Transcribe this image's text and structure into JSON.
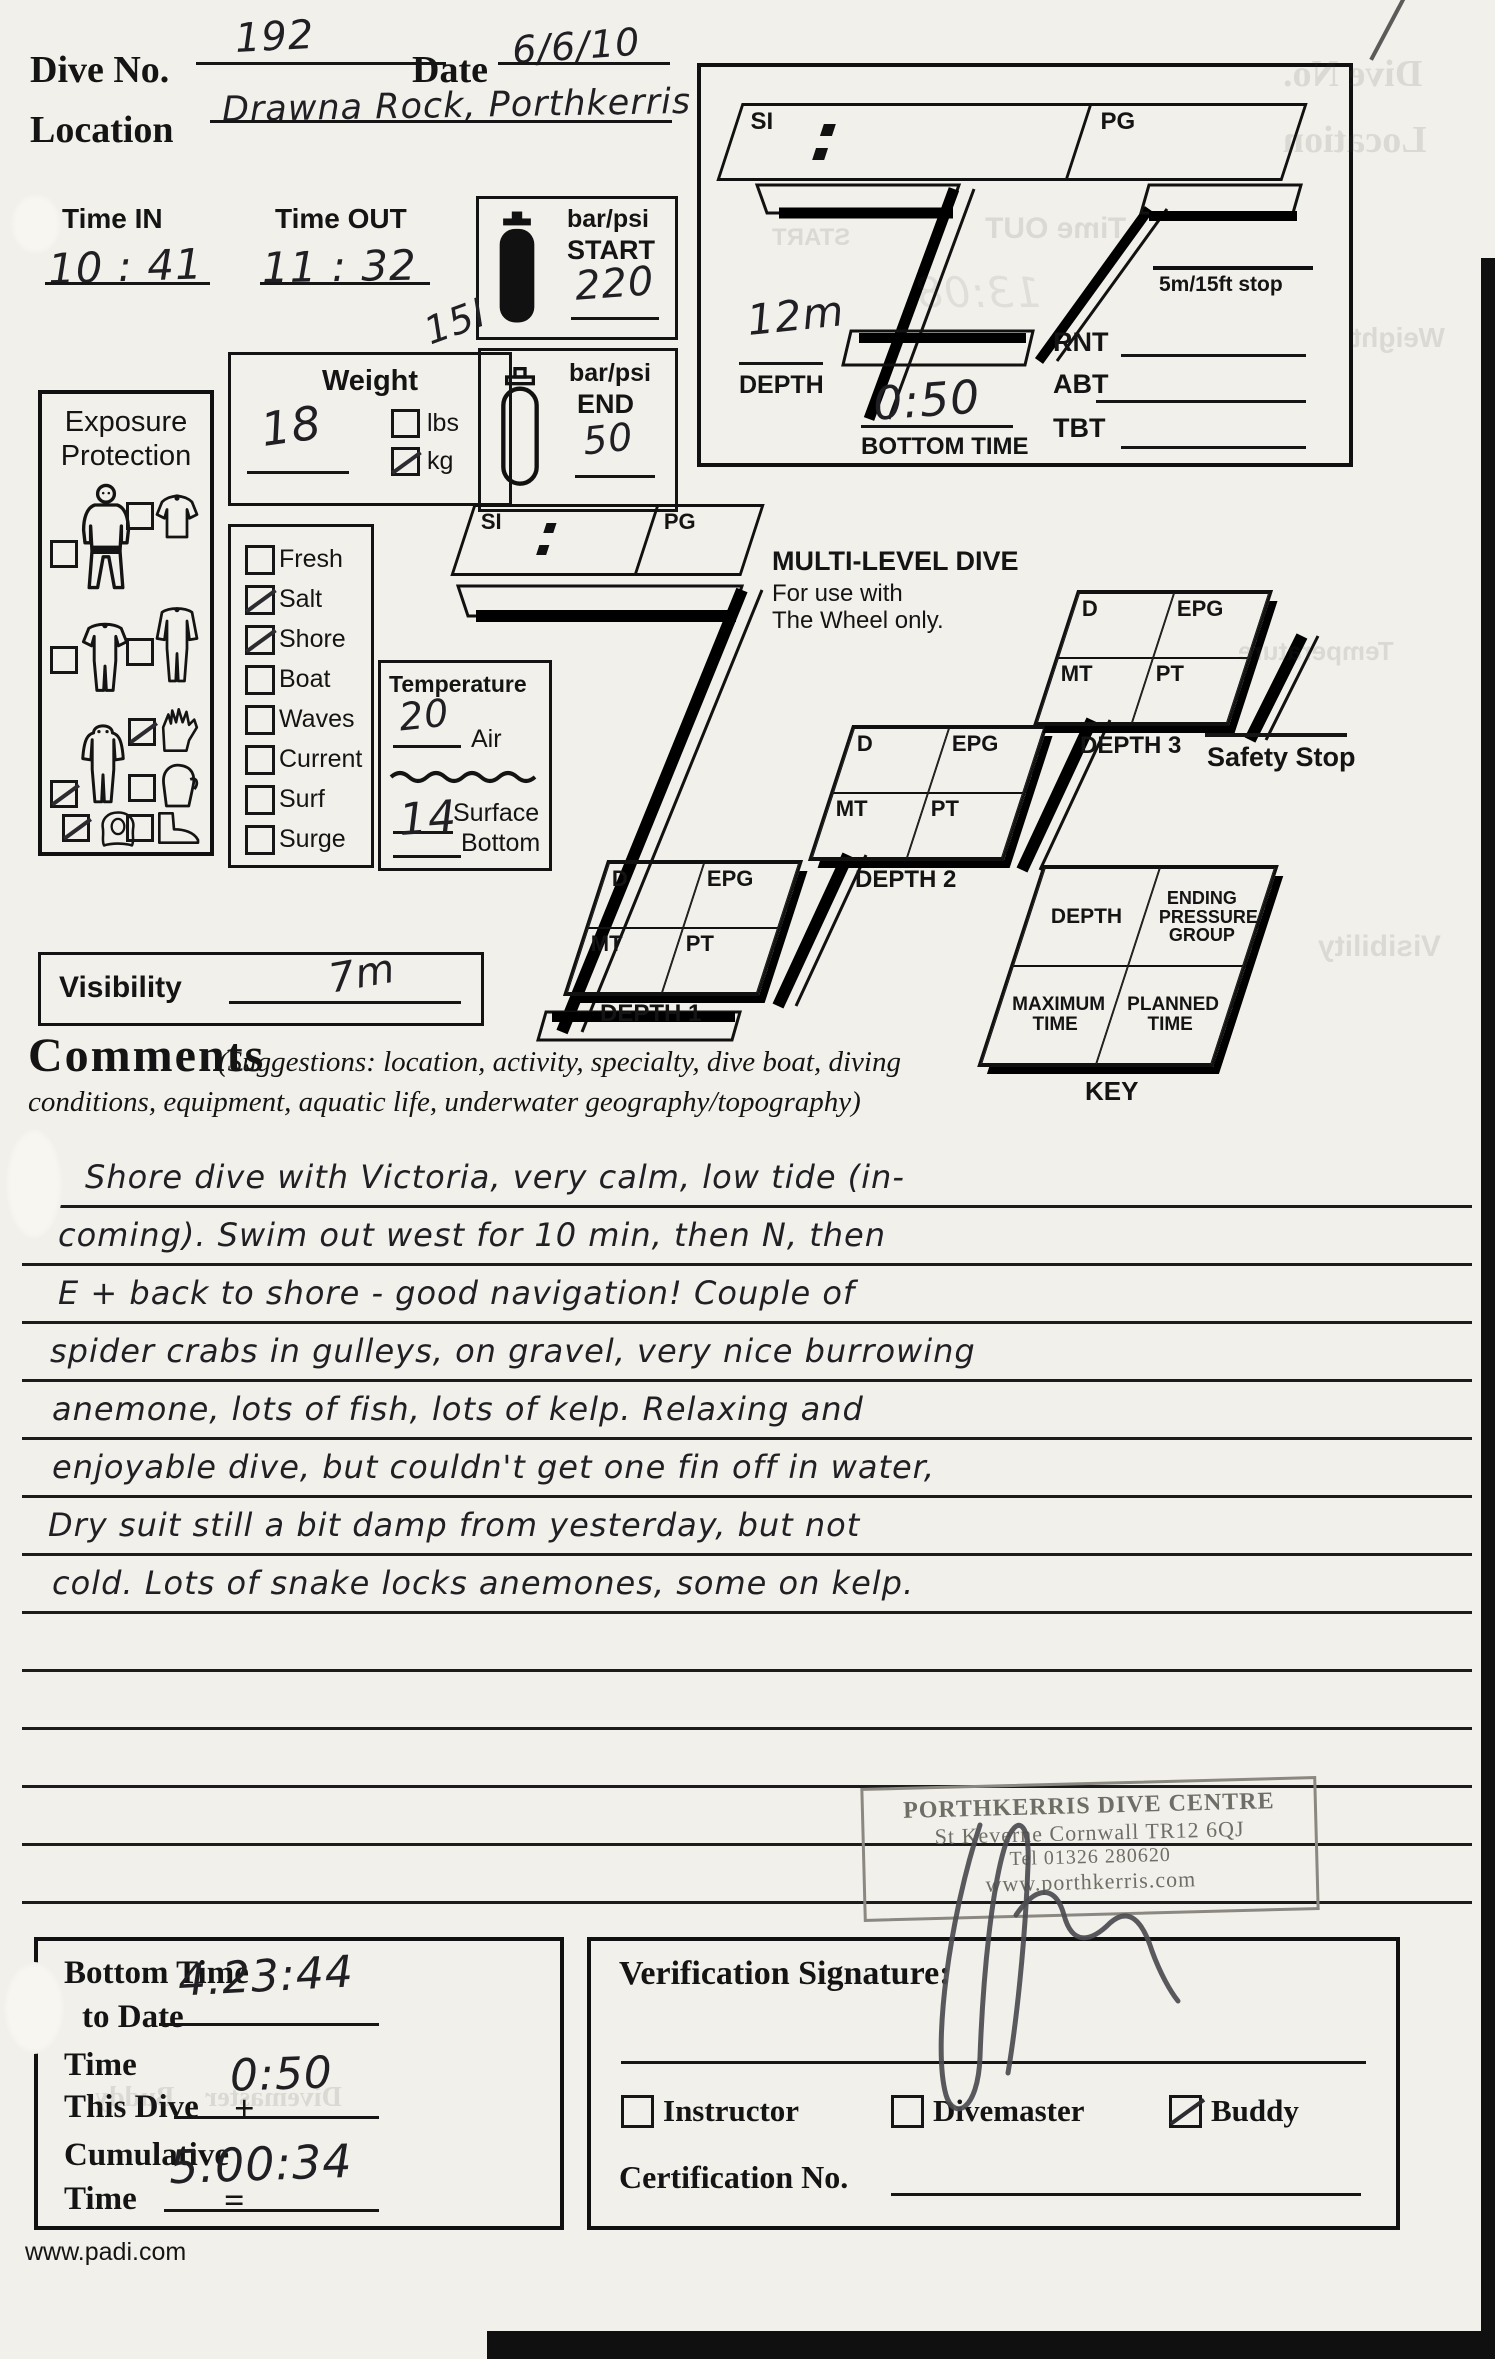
{
  "header": {
    "dive_no_label": "Dive No.",
    "dive_no_value": "192",
    "date_label": "Date",
    "date_value": "6/6/10",
    "location_label": "Location",
    "location_value": "Drawna Rock, Porthkerris",
    "time_in_label": "Time IN",
    "time_in_value": "10 : 41",
    "time_out_label": "Time OUT",
    "time_out_value": "11 : 32"
  },
  "tank": {
    "units_label": "bar/psi",
    "start_label": "START",
    "start_value": "220",
    "end_label": "END",
    "end_value": "50",
    "size_note": "15l"
  },
  "profile_top": {
    "si_label": "SI",
    "pg_label": "PG",
    "stop_label": "5m/15ft stop",
    "rnt_label": "RNT",
    "abt_label": "ABT",
    "tbt_label": "TBT",
    "depth_label": "DEPTH",
    "depth_value": "12m",
    "bottom_time_label": "BOTTOM TIME",
    "bottom_time_value": "0:50"
  },
  "weight": {
    "title": "Weight",
    "value": "18",
    "lbs_label": "lbs",
    "lbs_checked": false,
    "kg_label": "kg",
    "kg_checked": true
  },
  "exposure": {
    "title_line1": "Exposure",
    "title_line2": "Protection",
    "items": [
      {
        "name": "swimsuit",
        "checked": false
      },
      {
        "name": "vest",
        "checked": false
      },
      {
        "name": "shorty-suit",
        "checked": false
      },
      {
        "name": "jumpsuit",
        "checked": false
      },
      {
        "name": "hooded-suit",
        "checked": true
      },
      {
        "name": "gloves",
        "checked": true
      },
      {
        "name": "mitts",
        "checked": false
      },
      {
        "name": "hood",
        "checked": true
      },
      {
        "name": "boots",
        "checked": false
      }
    ]
  },
  "conditions": {
    "items": [
      {
        "label": "Fresh",
        "checked": false
      },
      {
        "label": "Salt",
        "checked": true
      },
      {
        "label": "Shore",
        "checked": true
      },
      {
        "label": "Boat",
        "checked": false
      },
      {
        "label": "Waves",
        "checked": false
      },
      {
        "label": "Current",
        "checked": false
      },
      {
        "label": "Surf",
        "checked": false
      },
      {
        "label": "Surge",
        "checked": false
      }
    ]
  },
  "temperature": {
    "title": "Temperature",
    "air_label": "Air",
    "air_value": "20",
    "surface_label": "Surface",
    "surface_value": "",
    "bottom_label": "Bottom",
    "bottom_value": "14"
  },
  "visibility": {
    "label": "Visibility",
    "value": "7m"
  },
  "multilevel": {
    "title": "MULTI-LEVEL DIVE",
    "subtitle1": "For use with",
    "subtitle2": "The Wheel only.",
    "si_label": "SI",
    "pg_label": "PG",
    "cell_d": "D",
    "cell_epg": "EPG",
    "cell_mt": "MT",
    "cell_pt": "PT",
    "depth1_label": "DEPTH 1",
    "depth2_label": "DEPTH 2",
    "depth3_label": "DEPTH 3",
    "safety_stop_label": "Safety Stop",
    "key": {
      "caption": "KEY",
      "cell_depth": "DEPTH",
      "cell_epg": "ENDING PRESSURE GROUP",
      "cell_max": "MAXIMUM TIME",
      "cell_planned": "PLANNED TIME"
    }
  },
  "comments": {
    "title": "Comments",
    "suggestions_line1": "(Suggestions: location, activity, specialty, dive boat, diving",
    "suggestions_line2": "conditions, equipment, aquatic life, underwater geography/topography)",
    "lines": [
      "Shore dive with Victoria, very calm, low tide (in-",
      "coming). Swim out west for 10 min, then N, then",
      "E + back to shore - good navigation! Couple of",
      "spider crabs in gulleys, on gravel, very nice burrowing",
      "anemone, lots of fish, lots of kelp. Relaxing and",
      "enjoyable dive, but couldn't get one fin off in water,",
      "Dry suit still a bit damp from yesterday, but not",
      "cold. Lots of snake locks anemones, some on kelp."
    ]
  },
  "stamp": {
    "line1": "PORTHKERRIS DIVE CENTRE",
    "line2": "St  Keverne  Cornwall TR12 6QJ",
    "line3": "Tel  01326 280620",
    "line4": "www.porthkerris.com"
  },
  "totals": {
    "bt_label1": "Bottom Time",
    "bt_label2": "to Date",
    "bt_value": "4.23:44",
    "time_label1": "Time",
    "time_label2": "This Dive",
    "plus_sign": "+",
    "time_value": "0:50",
    "cum_label1": "Cumulative",
    "cum_label2": "Time",
    "equals_sign": "=",
    "cum_value": "5.00:34"
  },
  "verification": {
    "title": "Verification Signature:",
    "roles": [
      {
        "label": "Instructor",
        "checked": false
      },
      {
        "label": "Divemaster",
        "checked": false
      },
      {
        "label": "Buddy",
        "checked": true
      }
    ],
    "cert_label": "Certification No."
  },
  "footer": {
    "url": "www.padi.com"
  },
  "ghosts": [
    "Time OUT",
    "START",
    "13:08",
    "Dive No.",
    "Location",
    "Weight",
    "Temperature",
    "Visibility",
    "Divemaster",
    "Buddy"
  ]
}
